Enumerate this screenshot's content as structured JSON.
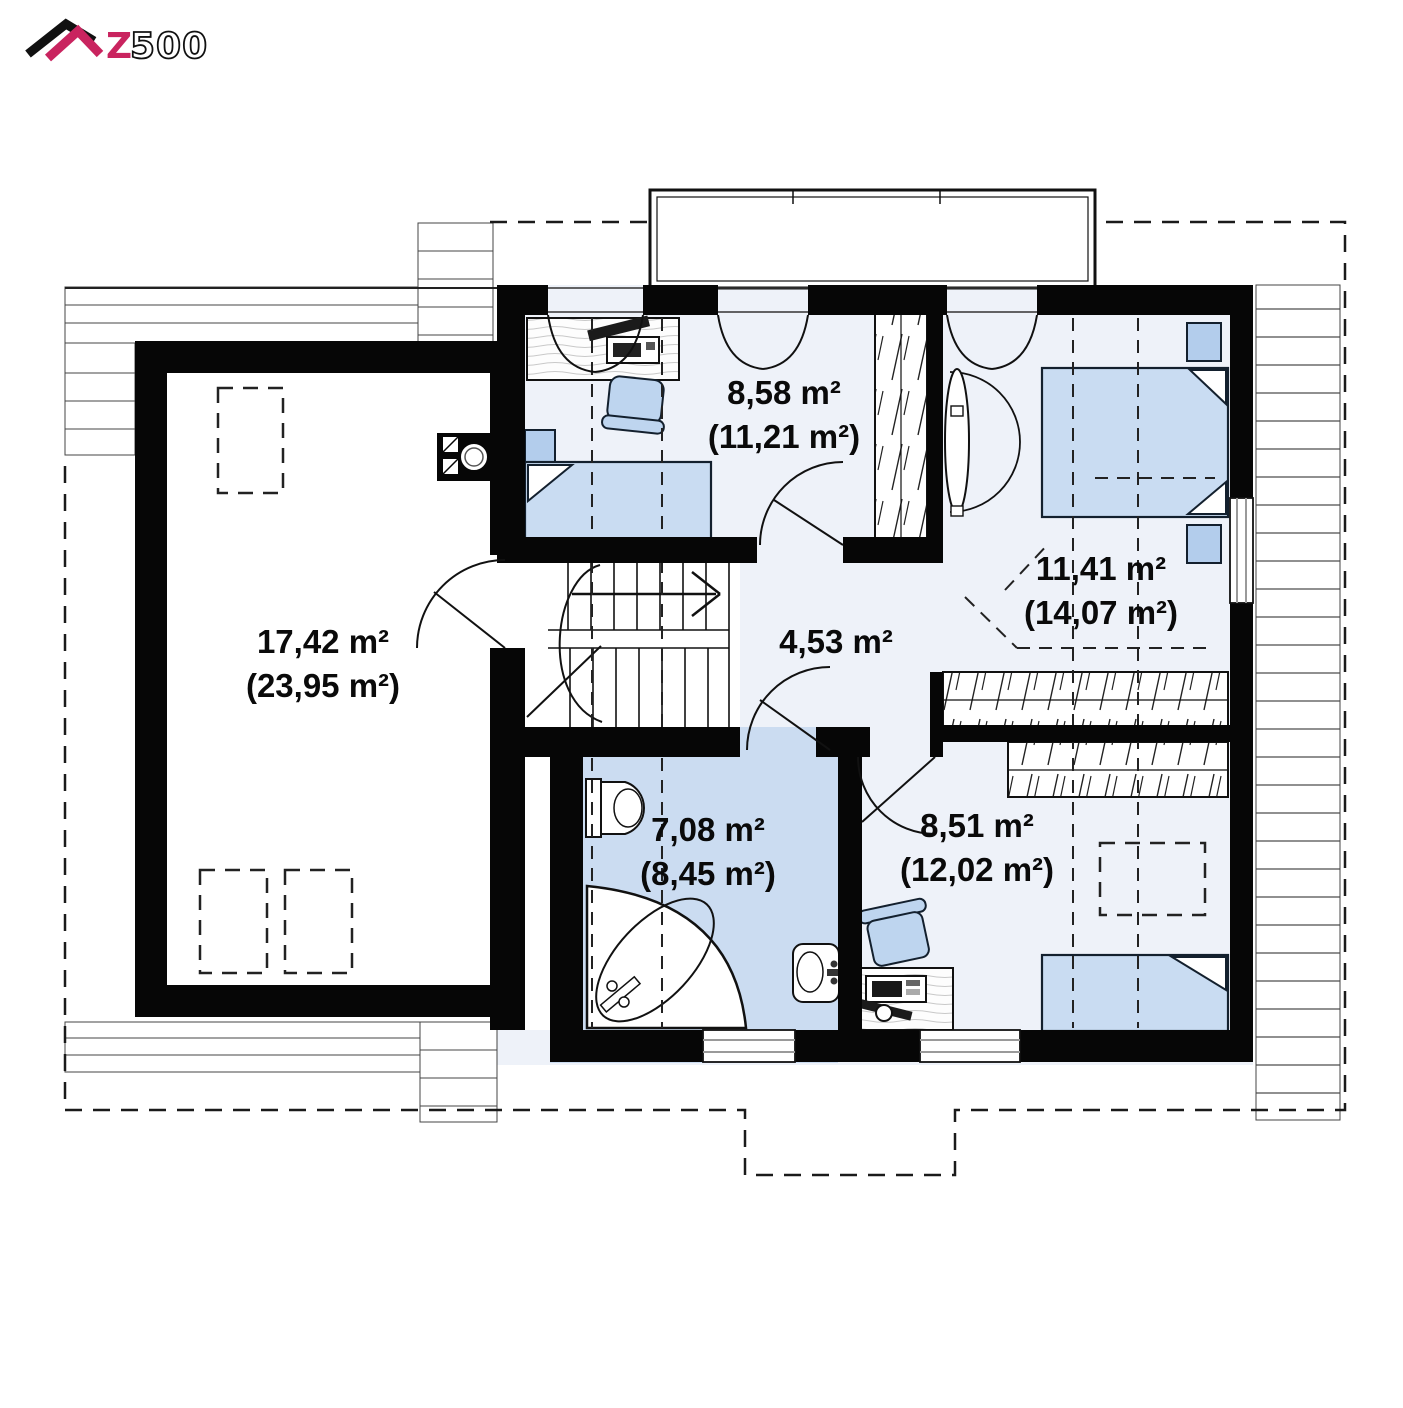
{
  "logo": {
    "brand_z": "Z",
    "brand_num": "500"
  },
  "colors": {
    "wall": "#060606",
    "room_floor": "#eef2f9",
    "bathroom_floor": "#cbdcf1",
    "furniture_blue": "#c9dcf2",
    "logo_accent": "#c9245f"
  },
  "rooms": [
    {
      "id": "attic-room",
      "area": "17,42 m²",
      "area_total": "(23,95 m²)"
    },
    {
      "id": "bedroom-top",
      "area": "8,58 m²",
      "area_total": "(11,21 m²)"
    },
    {
      "id": "bedroom-right",
      "area": "11,41 m²",
      "area_total": "(14,07 m²)"
    },
    {
      "id": "hall",
      "area": "4,53 m²",
      "area_total": ""
    },
    {
      "id": "bathroom",
      "area": "7,08 m²",
      "area_total": "(8,45 m²)"
    },
    {
      "id": "bedroom-bottom",
      "area": "8,51 m²",
      "area_total": "(12,02 m²)"
    }
  ]
}
